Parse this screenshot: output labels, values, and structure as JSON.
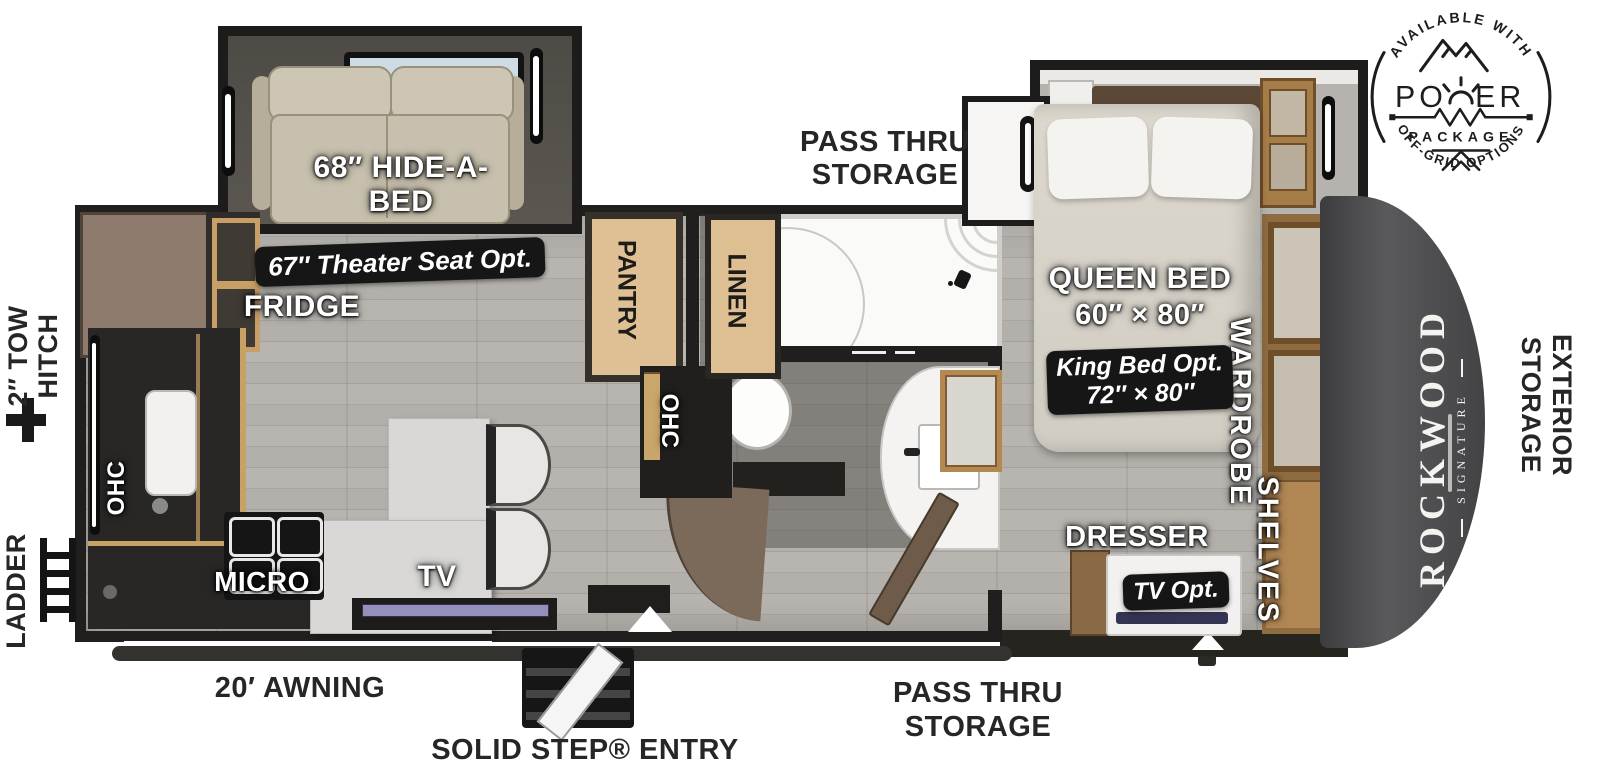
{
  "power_badge": {
    "available": "AVAILABLE WITH",
    "word": "POWER",
    "word_left": "PO",
    "word_right": "ER",
    "package": "PACKAGE",
    "off_grid": "OFF-GRID OPTIONS"
  },
  "exterior": {
    "pass_thru_top_1": "PASS THRU",
    "pass_thru_top_2": "STORAGE",
    "pass_thru_bottom_1": "PASS THRU",
    "pass_thru_bottom_2": "STORAGE",
    "tow_hitch_1": "2″ TOW",
    "tow_hitch_2": "HITCH",
    "ladder": "LADDER",
    "ext_storage_1": "EXTERIOR",
    "ext_storage_2": "STORAGE",
    "awning": "20′ AWNING",
    "entry": "SOLID STEP® ENTRY"
  },
  "living": {
    "hide_a_bed_1": "68″ HIDE-A-",
    "hide_a_bed_2": "BED",
    "theater_opt": "67″ Theater Seat Opt.",
    "fridge": "FRIDGE",
    "ohc_left": "OHC",
    "micro": "MICRO",
    "tv": "TV"
  },
  "hall": {
    "pantry": "PANTRY",
    "ohc_mid": "OHC",
    "linen": "LINEN"
  },
  "bedroom": {
    "queen": "QUEEN BED",
    "queen_size": "60″ × 80″",
    "king_opt_1": "King Bed Opt.",
    "king_opt_2": "72″ × 80″",
    "dresser": "DRESSER",
    "tv_opt": "TV Opt.",
    "wardrobe": "WARDROBE",
    "shelves": "SHELVES"
  },
  "brand": {
    "name": "ROCKWOOD",
    "sub": "SIGNATURE"
  },
  "colors": {
    "wall": "#201f1d",
    "floor": "#b3b0ab",
    "wood_trim": "#c8a265",
    "badge_bg": "#161616",
    "front_cap": "#4a4a4c"
  }
}
